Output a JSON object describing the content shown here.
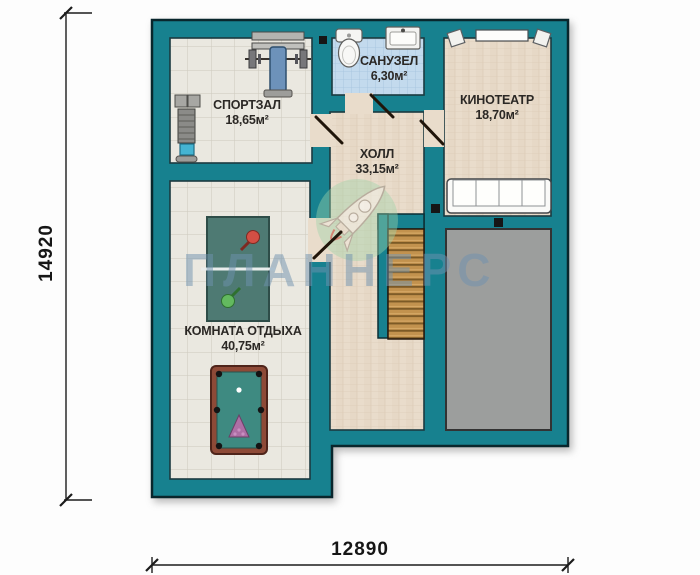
{
  "watermark": {
    "text": "ПЛАННЕРС"
  },
  "dimensions": {
    "left": "14920",
    "bottom": "12890"
  },
  "rooms": [
    {
      "id": "gym",
      "name": "СПОРТЗАЛ",
      "area": "18,65м²"
    },
    {
      "id": "bathroom",
      "name": "САНУЗЕЛ",
      "area": "6,30м²"
    },
    {
      "id": "cinema",
      "name": "КИНОТЕАТР",
      "area": "18,70м²"
    },
    {
      "id": "hall",
      "name": "ХОЛЛ",
      "area": "33,15м²"
    },
    {
      "id": "lounge",
      "name": "КОМНАТА ОТДЫХА",
      "area": "40,75м²"
    }
  ],
  "fixtures": {
    "gym": [
      "bench-press-icon",
      "weight-machine-icon"
    ],
    "bathroom": [
      "toilet-icon",
      "sink-icon"
    ],
    "cinema": [
      "tv-icon",
      "speaker-icon",
      "sofa-icon"
    ],
    "hall": [
      "stairs-icon"
    ],
    "lounge": [
      "ping-pong-table-icon",
      "pool-table-icon"
    ],
    "logo": [
      "rocket-logo-icon"
    ]
  },
  "colors": {
    "wall": "#17818f",
    "floor_tile": "#eae8e0",
    "floor_hall": "#e9dccb",
    "floor_bath": "#c3daed",
    "roof_gray": "#9c9e9d",
    "stairs_wood": "#c2924e",
    "watermark": "#6f92af"
  }
}
